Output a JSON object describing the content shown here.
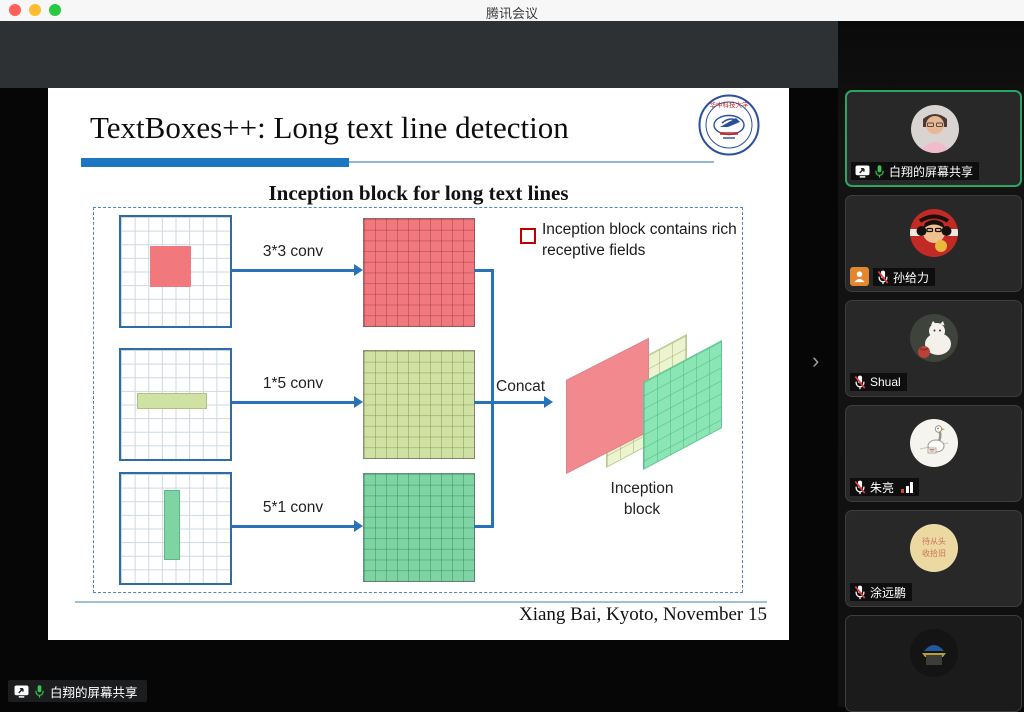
{
  "window": {
    "title": "腾讯会议"
  },
  "slide": {
    "title": "TextBoxes++: Long text line detection",
    "subtitle": "Inception block for long text lines",
    "logo_text": "华中科技大学",
    "bullet_text": "Inception block contains rich receptive fields",
    "rows": [
      {
        "conv_label": "3*3 conv",
        "input_pattern": "3x3 red square",
        "output_color": "#f1797d"
      },
      {
        "conv_label": "1*5 conv",
        "input_pattern": "1x5 horizontal light-green strip",
        "output_color": "#cfe2a4"
      },
      {
        "conv_label": "5*1 conv",
        "input_pattern": "5x1 vertical green strip",
        "output_color": "#7fd4a4"
      }
    ],
    "concat_label": "Concat",
    "inception_label": "Inception block",
    "credit": "Xiang Bai, Kyoto, November 15"
  },
  "sidebar": {
    "participants": [
      {
        "name": "白翔的屏幕共享",
        "mic": "on",
        "sharing": true,
        "active": true
      },
      {
        "name": "孙给力",
        "mic": "muted",
        "role_badge": true
      },
      {
        "name": "Shual",
        "mic": "muted"
      },
      {
        "name": "朱亮",
        "mic": "muted",
        "signal": true
      },
      {
        "name": "涂远鹏",
        "mic": "muted"
      },
      {
        "name": "",
        "partial": true
      }
    ]
  },
  "status_bar": {
    "share_label": "白翔的屏幕共享"
  },
  "icons": {
    "chevron": "›"
  },
  "colors": {
    "accent_blue": "#2a72b8",
    "title_bar_blue": "#1c77c3",
    "red_fill": "#f1797d",
    "light_green_fill": "#cfe2a4",
    "green_fill": "#7fd4a4",
    "bullet_red": "#c00000",
    "active_tile_border": "#29a566",
    "mic_on_green": "#35c552",
    "muted_slash_red": "#e23b3b",
    "role_badge_orange": "#e2862f"
  }
}
